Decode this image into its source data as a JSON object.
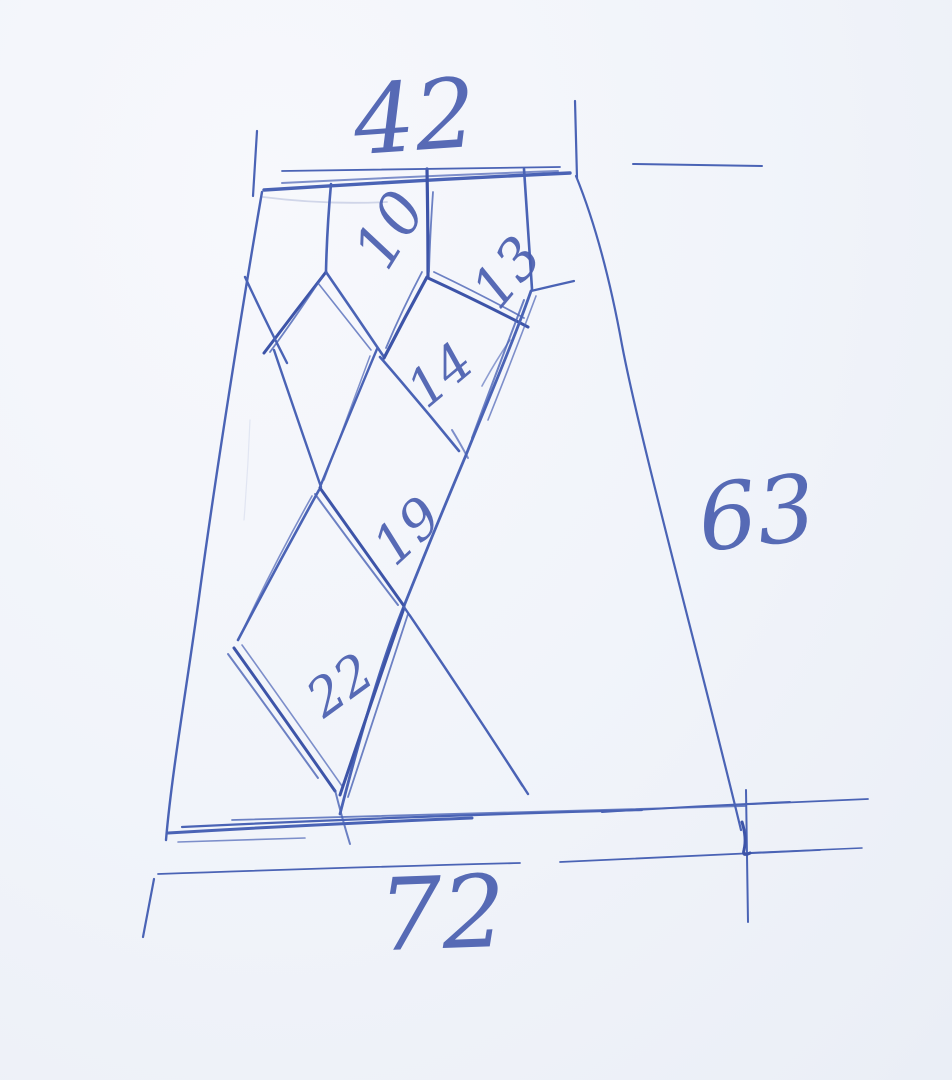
{
  "sketch": {
    "description": "Hand-drawn ballpoint-pen draft of a trapezoidal pattern piece with a diamond (argyle) lattice and handwritten dimension annotations",
    "ink_color": "#4a63b5",
    "paper_color": "#f1f4fa",
    "dimensions": {
      "top": "42",
      "right": "63",
      "bottom": "72"
    },
    "cells": {
      "c10": "10",
      "c13": "13",
      "c14": "14",
      "c19": "19",
      "c22": "22"
    }
  }
}
